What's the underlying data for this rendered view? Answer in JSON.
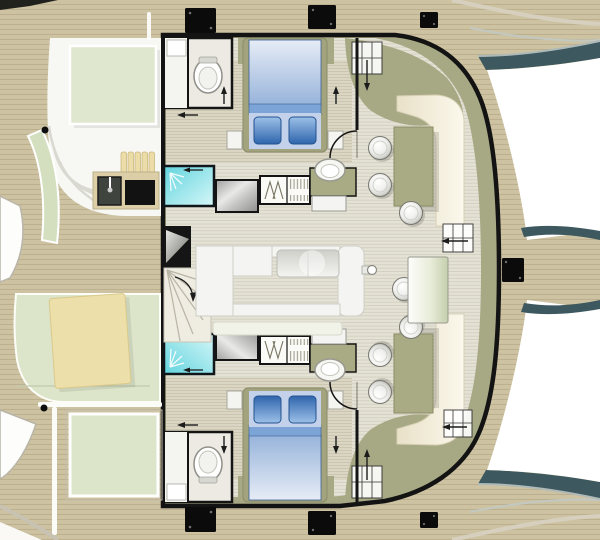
{
  "palette": {
    "background": "#ffffff",
    "deck_wood": "#cdc3a2",
    "deck_plank_line": "#a2946f",
    "hull_teal": "#3d585e",
    "hull_teal_edge": "#aebab9",
    "hull_outline": "#131313",
    "trim_olive": "#a7a884",
    "interior_floor": "#e4e2d5",
    "floor_line": "#b9b6a4",
    "carpet": "#dad6c3",
    "carpet_line": "#aaa48a",
    "bed_platform": "#a3a47e",
    "bed_duvet_light": "#e6ecf6",
    "bed_duvet_dark": "#96b3da",
    "bed_band": "#7ca4d6",
    "bed_pillow_light": "#9cc0e8",
    "bed_pillow_dark": "#2f65ad",
    "shower_aqua": "#62d4de",
    "shower_aqua_light": "#d6f7f8",
    "counter_white": "#f4f4f2",
    "bench_cream_dark": "#e9e1c8",
    "bench_cream_light": "#fbf8ec",
    "bench_green": "#d4dfbf",
    "pad_green": "#dce4c9",
    "table_green": "#dfe7ce",
    "table_olive": "#a9ab84",
    "table_tan": "#ecdfaa",
    "galley_tan": "#dccfa7",
    "sink_dark": "#3f443f",
    "grill_black": "#121212",
    "hatch_black": "#0b0b0b",
    "white_structure": "#f7f7f4",
    "stair_dark": "#151515",
    "arrow_black": "#1c1c1c"
  }
}
